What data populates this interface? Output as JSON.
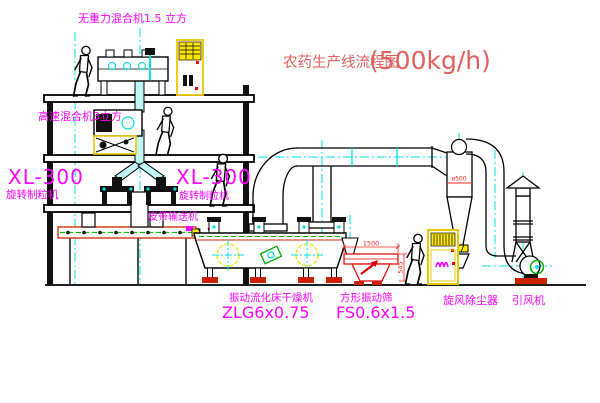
{
  "diagram": {
    "title": {
      "name": "农药生产线流程图",
      "capacity": "(500kg/h)"
    },
    "equipment": {
      "gravity_mixer": "无重力混合机1.5 立方",
      "high_speed_mixer": "高速混合机3立方",
      "granulator_left_model": "XL-300",
      "granulator_left_name": "旋转制粒机",
      "granulator_right_model": "XL-300",
      "granulator_right_name": "旋转制粒机",
      "belt_conveyor": "皮带输送机",
      "fluid_bed_dryer": "振动流化床干燥机",
      "fluid_bed_dryer_model": "ZLG6x0.75",
      "vibrating_screen": "方形振动筛",
      "vibrating_screen_model": "FS0.6x1.5",
      "cyclone": "旋风除尘器",
      "induced_draft_fan": "引风机"
    },
    "dimensions": {
      "screen_length": "1500",
      "screen_width": "545",
      "cyclone_diameter": "ø500"
    },
    "colors": {
      "line": "#000000",
      "centerline": "#00e0e0",
      "label_magenta": "#ff00ff",
      "title_red": "#e06060",
      "dimension_red": "#ff2222",
      "panel_yellow": "#e8c800",
      "alarm_red": "#ff0000",
      "machine_green": "#00aa00",
      "foot_red": "#cc2200"
    }
  }
}
